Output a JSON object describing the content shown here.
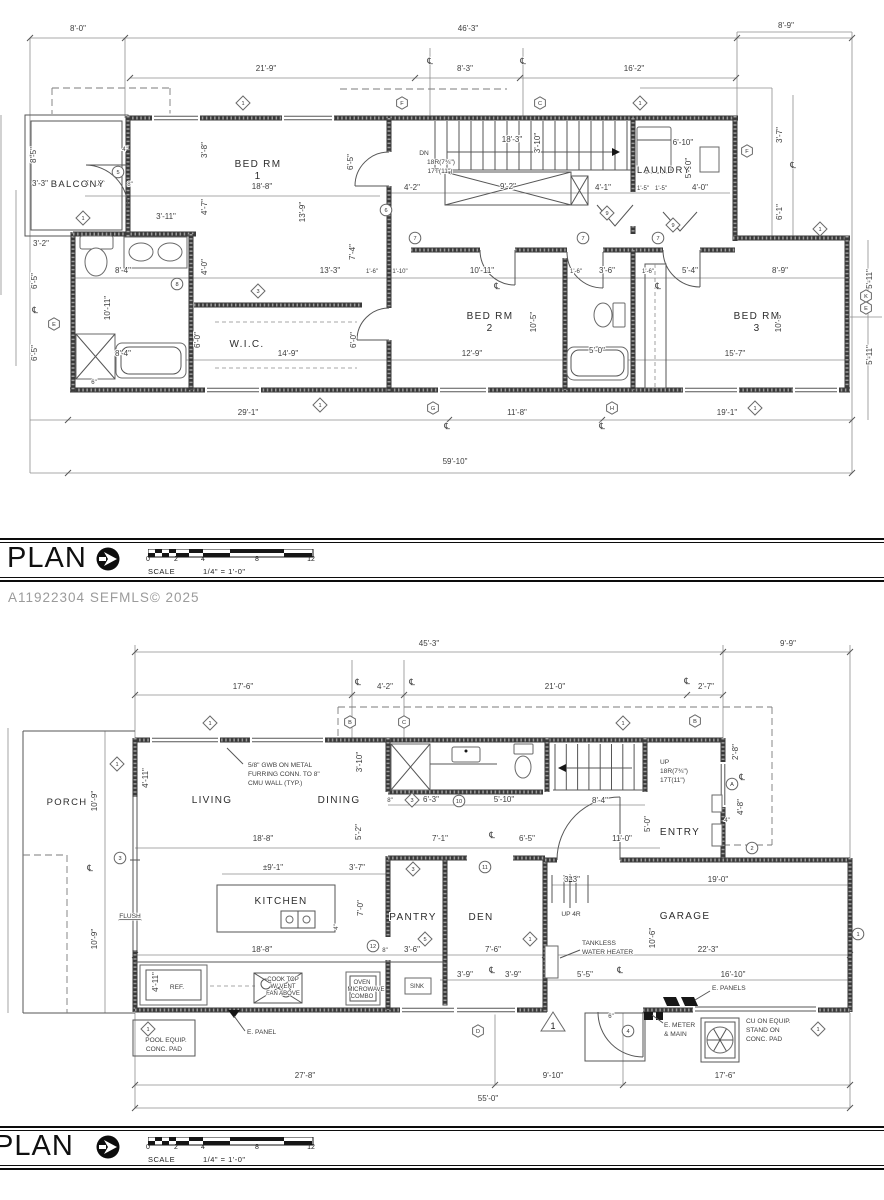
{
  "watermark": "A11922304  SEFMLS© 2025",
  "title_bar": {
    "title": "PLAN",
    "scale_word": "SCALE",
    "scale_value": "1/4\" = 1'-0\"",
    "ticks": [
      "0",
      "2",
      "4",
      "8",
      "12"
    ]
  },
  "centerline_symbol": "℄",
  "upper_plan": {
    "rooms": [
      {
        "t": "BALCONY",
        "x": 78,
        "y": 187,
        "s": 9.5
      },
      {
        "t": "BED RM",
        "x": 258,
        "y": 167
      },
      {
        "t": "1",
        "x": 258,
        "y": 179
      },
      {
        "t": "LAUNDRY",
        "x": 664,
        "y": 173,
        "s": 9.5
      },
      {
        "t": "W.I.C.",
        "x": 247,
        "y": 347
      },
      {
        "t": "BED RM",
        "x": 490,
        "y": 319
      },
      {
        "t": "2",
        "x": 490,
        "y": 331
      },
      {
        "t": "BED RM",
        "x": 757,
        "y": 319
      },
      {
        "t": "3",
        "x": 757,
        "y": 331
      }
    ],
    "dims": [
      {
        "t": "8'-0\"",
        "x": 78,
        "y": 31
      },
      {
        "t": "46'-3\"",
        "x": 468,
        "y": 31
      },
      {
        "t": "8'-9\"",
        "x": 786,
        "y": 28
      },
      {
        "t": "21'-9\"",
        "x": 266,
        "y": 71
      },
      {
        "t": "8'-3\"",
        "x": 465,
        "y": 71
      },
      {
        "t": "16'-2\"",
        "x": 634,
        "y": 71
      },
      {
        "t": "8'-5\"",
        "x": 36,
        "y": 155,
        "v": 1
      },
      {
        "t": "3'-3\"",
        "x": 40,
        "y": 186
      },
      {
        "t": "4'-10\"",
        "x": 95,
        "y": 186
      },
      {
        "t": "8\"",
        "x": 130,
        "y": 186,
        "s": 6
      },
      {
        "t": "4\"",
        "x": 125,
        "y": 151,
        "s": 6
      },
      {
        "t": "3'-11\"",
        "x": 166,
        "y": 219
      },
      {
        "t": "3'-2\"",
        "x": 41,
        "y": 246
      },
      {
        "t": "6'-5\"",
        "x": 37,
        "y": 281,
        "v": 1
      },
      {
        "t": "6'-5\"",
        "x": 37,
        "y": 353,
        "v": 1
      },
      {
        "t": "10'-11\"",
        "x": 110,
        "y": 308,
        "v": 1
      },
      {
        "t": "8'-4\"",
        "x": 123,
        "y": 273
      },
      {
        "t": "8'-4\"",
        "x": 123,
        "y": 356
      },
      {
        "t": "6\"",
        "x": 94,
        "y": 384,
        "s": 6
      },
      {
        "t": "18'-8\"",
        "x": 262,
        "y": 189
      },
      {
        "t": "3'-8\"",
        "x": 207,
        "y": 150,
        "v": 1
      },
      {
        "t": "4'-7\"",
        "x": 207,
        "y": 207,
        "v": 1
      },
      {
        "t": "4'-0\"",
        "x": 207,
        "y": 267,
        "v": 1
      },
      {
        "t": "13'-9\"",
        "x": 305,
        "y": 212,
        "v": 1
      },
      {
        "t": "6'-5\"",
        "x": 353,
        "y": 162,
        "v": 1
      },
      {
        "t": "7'-4\"",
        "x": 355,
        "y": 252,
        "v": 1
      },
      {
        "t": "13'-3\"",
        "x": 330,
        "y": 273
      },
      {
        "t": "4'-2\"",
        "x": 412,
        "y": 190
      },
      {
        "t": "9'-2\"",
        "x": 508,
        "y": 189
      },
      {
        "t": "4'-1\"",
        "x": 603,
        "y": 190
      },
      {
        "t": "1'-5\"",
        "x": 643,
        "y": 190,
        "s": 6
      },
      {
        "t": "1'-5\"",
        "x": 661,
        "y": 190,
        "s": 6
      },
      {
        "t": "4'-0\"",
        "x": 700,
        "y": 190
      },
      {
        "t": "3'-10\"",
        "x": 540,
        "y": 143,
        "v": 1
      },
      {
        "t": "18'-3\"",
        "x": 512,
        "y": 142
      },
      {
        "t": "6'-10\"",
        "x": 683,
        "y": 145
      },
      {
        "t": "5'-10\"",
        "x": 691,
        "y": 168,
        "v": 1
      },
      {
        "t": "1'-6\"",
        "x": 372,
        "y": 273,
        "s": 6
      },
      {
        "t": "1'-10\"",
        "x": 400,
        "y": 273,
        "s": 6
      },
      {
        "t": "10'-11\"",
        "x": 482,
        "y": 273
      },
      {
        "t": "1'-6\"",
        "x": 576,
        "y": 273,
        "s": 6
      },
      {
        "t": "3'-6\"",
        "x": 607,
        "y": 273
      },
      {
        "t": "1'-6\"",
        "x": 648,
        "y": 273,
        "s": 6
      },
      {
        "t": "5'-4\"",
        "x": 690,
        "y": 273
      },
      {
        "t": "8'-9\"",
        "x": 780,
        "y": 273
      },
      {
        "t": "14'-9\"",
        "x": 288,
        "y": 356
      },
      {
        "t": "12'-9\"",
        "x": 472,
        "y": 356
      },
      {
        "t": "5'-0\"",
        "x": 597,
        "y": 353
      },
      {
        "t": "15'-7\"",
        "x": 735,
        "y": 356
      },
      {
        "t": "6'-0\"",
        "x": 200,
        "y": 340,
        "v": 1
      },
      {
        "t": "6'-0\"",
        "x": 356,
        "y": 340,
        "v": 1
      },
      {
        "t": "10'-5\"",
        "x": 536,
        "y": 322,
        "v": 1
      },
      {
        "t": "10'-6\"",
        "x": 781,
        "y": 322,
        "v": 1
      },
      {
        "t": "3'-7\"",
        "x": 782,
        "y": 135,
        "v": 1
      },
      {
        "t": "6'-1\"",
        "x": 782,
        "y": 212,
        "v": 1
      },
      {
        "t": "5'-11\"",
        "x": 872,
        "y": 279,
        "v": 1
      },
      {
        "t": "5'-11\"",
        "x": 872,
        "y": 355,
        "v": 1
      },
      {
        "t": "29'-1\"",
        "x": 248,
        "y": 415
      },
      {
        "t": "11'-8\"",
        "x": 517,
        "y": 415
      },
      {
        "t": "19'-1\"",
        "x": 727,
        "y": 415
      },
      {
        "t": "59'-10\"",
        "x": 455,
        "y": 464
      }
    ],
    "notes": [
      {
        "t": "DN",
        "x": 424,
        "y": 155
      },
      {
        "t": "18R(7¾\")",
        "x": 441,
        "y": 164
      },
      {
        "t": "17T(11\")",
        "x": 440,
        "y": 173
      }
    ],
    "centerlines": [
      [
        430,
        64
      ],
      [
        523,
        64
      ],
      [
        793,
        168
      ],
      [
        35,
        313
      ],
      [
        497,
        289
      ],
      [
        658,
        289
      ],
      [
        447,
        429
      ],
      [
        602,
        429
      ]
    ],
    "markers": [
      {
        "k": "d",
        "t": "1",
        "x": 243,
        "y": 103
      },
      {
        "k": "h",
        "t": "F",
        "x": 402,
        "y": 103
      },
      {
        "k": "h",
        "t": "C",
        "x": 540,
        "y": 103
      },
      {
        "k": "d",
        "t": "1",
        "x": 640,
        "y": 103
      },
      {
        "k": "d",
        "t": "1",
        "x": 83,
        "y": 218
      },
      {
        "k": "c",
        "t": "5",
        "x": 118,
        "y": 172
      },
      {
        "k": "c",
        "t": "8",
        "x": 177,
        "y": 284
      },
      {
        "k": "d",
        "t": "3",
        "x": 258,
        "y": 291
      },
      {
        "k": "c",
        "t": "6",
        "x": 386,
        "y": 210
      },
      {
        "k": "c",
        "t": "7",
        "x": 415,
        "y": 238
      },
      {
        "k": "c",
        "t": "7",
        "x": 583,
        "y": 238
      },
      {
        "k": "c",
        "t": "7",
        "x": 658,
        "y": 238
      },
      {
        "k": "d",
        "t": "9",
        "x": 607,
        "y": 213
      },
      {
        "k": "d",
        "t": "9",
        "x": 673,
        "y": 225
      },
      {
        "k": "h",
        "t": "F",
        "x": 747,
        "y": 151
      },
      {
        "k": "d",
        "t": "1",
        "x": 820,
        "y": 229
      },
      {
        "k": "h",
        "t": "K",
        "x": 866,
        "y": 296
      },
      {
        "k": "h",
        "t": "E",
        "x": 866,
        "y": 308
      },
      {
        "k": "h",
        "t": "E",
        "x": 54,
        "y": 324
      },
      {
        "k": "h",
        "t": "G",
        "x": 433,
        "y": 408
      },
      {
        "k": "h",
        "t": "H",
        "x": 612,
        "y": 408
      },
      {
        "k": "d",
        "t": "1",
        "x": 320,
        "y": 405
      },
      {
        "k": "d",
        "t": "1",
        "x": 755,
        "y": 408
      }
    ]
  },
  "lower_plan": {
    "rooms": [
      {
        "t": "PORCH",
        "x": 67,
        "y": 805,
        "s": 9.5
      },
      {
        "t": "LIVING",
        "x": 212,
        "y": 803
      },
      {
        "t": "DINING",
        "x": 339,
        "y": 803
      },
      {
        "t": "ENTRY",
        "x": 680,
        "y": 835
      },
      {
        "t": "KITCHEN",
        "x": 281,
        "y": 904
      },
      {
        "t": "PANTRY",
        "x": 413,
        "y": 920
      },
      {
        "t": "DEN",
        "x": 481,
        "y": 920
      },
      {
        "t": "GARAGE",
        "x": 685,
        "y": 919
      }
    ],
    "dims": [
      {
        "t": "45'-3\"",
        "x": 429,
        "y": 646
      },
      {
        "t": "9'-9\"",
        "x": 788,
        "y": 646
      },
      {
        "t": "17'-6\"",
        "x": 243,
        "y": 689
      },
      {
        "t": "4'-2\"",
        "x": 385,
        "y": 689
      },
      {
        "t": "21'-0\"",
        "x": 555,
        "y": 689
      },
      {
        "t": "2'-7\"",
        "x": 706,
        "y": 689
      },
      {
        "t": "10'-9\"",
        "x": 97,
        "y": 801,
        "v": 1
      },
      {
        "t": "10'-9\"",
        "x": 97,
        "y": 939,
        "v": 1
      },
      {
        "t": "4'-11\"",
        "x": 148,
        "y": 778,
        "v": 1
      },
      {
        "t": "3'-10\"",
        "x": 362,
        "y": 762,
        "v": 1
      },
      {
        "t": "5'-2\"",
        "x": 361,
        "y": 832,
        "v": 1
      },
      {
        "t": "8\"",
        "x": 390,
        "y": 802,
        "s": 6
      },
      {
        "t": "6'-3\"",
        "x": 431,
        "y": 802
      },
      {
        "t": "5'-10\"",
        "x": 504,
        "y": 802
      },
      {
        "t": "8'-4\"",
        "x": 600,
        "y": 803
      },
      {
        "t": "18'-8\"",
        "x": 263,
        "y": 841
      },
      {
        "t": "7'-1\"",
        "x": 440,
        "y": 841
      },
      {
        "t": "6'-5\"",
        "x": 527,
        "y": 841
      },
      {
        "t": "11'-0\"",
        "x": 622,
        "y": 841
      },
      {
        "t": "5'-0\"",
        "x": 650,
        "y": 824,
        "v": 1
      },
      {
        "t": "2'-8\"",
        "x": 738,
        "y": 752,
        "v": 1
      },
      {
        "t": "4'-8\"",
        "x": 743,
        "y": 807,
        "v": 1
      },
      {
        "t": "4\"",
        "x": 727,
        "y": 822,
        "s": 6
      },
      {
        "t": "±9'-1\"",
        "x": 273,
        "y": 870
      },
      {
        "t": "3'-7\"",
        "x": 357,
        "y": 870
      },
      {
        "t": "7'-0\"",
        "x": 363,
        "y": 908,
        "v": 1
      },
      {
        "t": "4\"",
        "x": 338,
        "y": 927,
        "v": 1,
        "s": 6
      },
      {
        "t": "18'-8\"",
        "x": 262,
        "y": 952
      },
      {
        "t": "8\"",
        "x": 385,
        "y": 952,
        "s": 6
      },
      {
        "t": "3'-6\"",
        "x": 412,
        "y": 952
      },
      {
        "t": "7'-6\"",
        "x": 493,
        "y": 952
      },
      {
        "t": "3'-9\"",
        "x": 465,
        "y": 977
      },
      {
        "t": "3'-9\"",
        "x": 513,
        "y": 977
      },
      {
        "t": "4'-11\"",
        "x": 158,
        "y": 982,
        "v": 1
      },
      {
        "t": "3'-3\"",
        "x": 572,
        "y": 882
      },
      {
        "t": "19'-0\"",
        "x": 718,
        "y": 882
      },
      {
        "t": "10'-6\"",
        "x": 655,
        "y": 938,
        "v": 1
      },
      {
        "t": "22'-3\"",
        "x": 708,
        "y": 952
      },
      {
        "t": "5'-5\"",
        "x": 585,
        "y": 977
      },
      {
        "t": "16'-10\"",
        "x": 733,
        "y": 977
      },
      {
        "t": "6\"",
        "x": 611,
        "y": 1018,
        "s": 6
      },
      {
        "t": "27'-8\"",
        "x": 305,
        "y": 1078
      },
      {
        "t": "9'-10\"",
        "x": 553,
        "y": 1078
      },
      {
        "t": "17'-6\"",
        "x": 725,
        "y": 1078
      },
      {
        "t": "55'-0\"",
        "x": 488,
        "y": 1101
      }
    ],
    "notes": [
      {
        "t": "5/8\" GWB ON METAL",
        "x": 248,
        "y": 767,
        "a": 1
      },
      {
        "t": "FURRING CONN. TO 8\"",
        "x": 248,
        "y": 776,
        "a": 1
      },
      {
        "t": "CMU WALL (TYP.)",
        "x": 248,
        "y": 785,
        "a": 1
      },
      {
        "t": "UP",
        "x": 660,
        "y": 764,
        "a": 1
      },
      {
        "t": "18R(7¾\")",
        "x": 660,
        "y": 773,
        "a": 1
      },
      {
        "t": "17T(11\")",
        "x": 660,
        "y": 782,
        "a": 1
      },
      {
        "t": "TANKLESS",
        "x": 582,
        "y": 945,
        "a": 1
      },
      {
        "t": "WATER HEATER",
        "x": 582,
        "y": 954,
        "a": 1
      },
      {
        "t": "E. PANELS",
        "x": 712,
        "y": 990,
        "a": 1
      },
      {
        "t": "E. METER",
        "x": 664,
        "y": 1027,
        "a": 1
      },
      {
        "t": "& MAIN",
        "x": 664,
        "y": 1036,
        "a": 1
      },
      {
        "t": "CU ON EQUIP.",
        "x": 746,
        "y": 1023,
        "a": 1
      },
      {
        "t": "STAND ON",
        "x": 746,
        "y": 1032,
        "a": 1
      },
      {
        "t": "CONC. PAD",
        "x": 746,
        "y": 1041,
        "a": 1
      },
      {
        "t": "E. PANEL",
        "x": 247,
        "y": 1034,
        "a": 1
      },
      {
        "t": "POOL EQUIP.",
        "x": 166,
        "y": 1042
      },
      {
        "t": "CONC. PAD",
        "x": 164,
        "y": 1051
      },
      {
        "t": "FLUSH",
        "x": 130,
        "y": 918,
        "u": 1
      },
      {
        "t": "REF.",
        "x": 177,
        "y": 989
      },
      {
        "t": "SINK",
        "x": 417,
        "y": 988,
        "s": 6
      },
      {
        "t": "OVEN",
        "x": 362,
        "y": 984,
        "s": 6
      },
      {
        "t": "MICROWAVE",
        "x": 366,
        "y": 991,
        "s": 6
      },
      {
        "t": "COMBO",
        "x": 362,
        "y": 998,
        "s": 6
      },
      {
        "t": "COOK TOP",
        "x": 283,
        "y": 981,
        "s": 6
      },
      {
        "t": "W/ VENT",
        "x": 283,
        "y": 988,
        "s": 6
      },
      {
        "t": "FAN ABOVE",
        "x": 283,
        "y": 995,
        "s": 6
      },
      {
        "t": "UP 4R",
        "x": 571,
        "y": 916
      }
    ],
    "centerlines": [
      [
        358,
        685
      ],
      [
        412,
        685
      ],
      [
        687,
        684
      ],
      [
        90,
        871
      ],
      [
        492,
        838
      ],
      [
        492,
        973
      ],
      [
        620,
        973
      ],
      [
        742,
        780
      ]
    ],
    "markers": [
      {
        "k": "d",
        "t": "1",
        "x": 210,
        "y": 723
      },
      {
        "k": "h",
        "t": "B",
        "x": 350,
        "y": 722
      },
      {
        "k": "h",
        "t": "C",
        "x": 404,
        "y": 722
      },
      {
        "k": "d",
        "t": "1",
        "x": 623,
        "y": 723
      },
      {
        "k": "h",
        "t": "B",
        "x": 695,
        "y": 721
      },
      {
        "k": "d",
        "t": "1",
        "x": 117,
        "y": 764
      },
      {
        "k": "c",
        "t": "3",
        "x": 120,
        "y": 858
      },
      {
        "k": "d",
        "t": "3",
        "x": 412,
        "y": 800
      },
      {
        "k": "c",
        "t": "10",
        "x": 459,
        "y": 801
      },
      {
        "k": "c",
        "t": "11",
        "x": 485,
        "y": 867
      },
      {
        "k": "d",
        "t": "3",
        "x": 413,
        "y": 869
      },
      {
        "k": "c",
        "t": "12",
        "x": 373,
        "y": 946
      },
      {
        "k": "d",
        "t": "5",
        "x": 425,
        "y": 939
      },
      {
        "k": "d",
        "t": "1",
        "x": 530,
        "y": 939
      },
      {
        "k": "c",
        "t": "A",
        "x": 732,
        "y": 784
      },
      {
        "k": "c",
        "t": "2",
        "x": 752,
        "y": 848
      },
      {
        "k": "c",
        "t": "4",
        "x": 628,
        "y": 1031
      },
      {
        "k": "h",
        "t": "D",
        "x": 478,
        "y": 1031
      },
      {
        "k": "t",
        "t": "1",
        "x": 553,
        "y": 1024
      },
      {
        "k": "d",
        "t": "1",
        "x": 148,
        "y": 1029
      },
      {
        "k": "d",
        "t": "1",
        "x": 818,
        "y": 1029
      },
      {
        "k": "c",
        "t": "1",
        "x": 858,
        "y": 934
      }
    ]
  }
}
